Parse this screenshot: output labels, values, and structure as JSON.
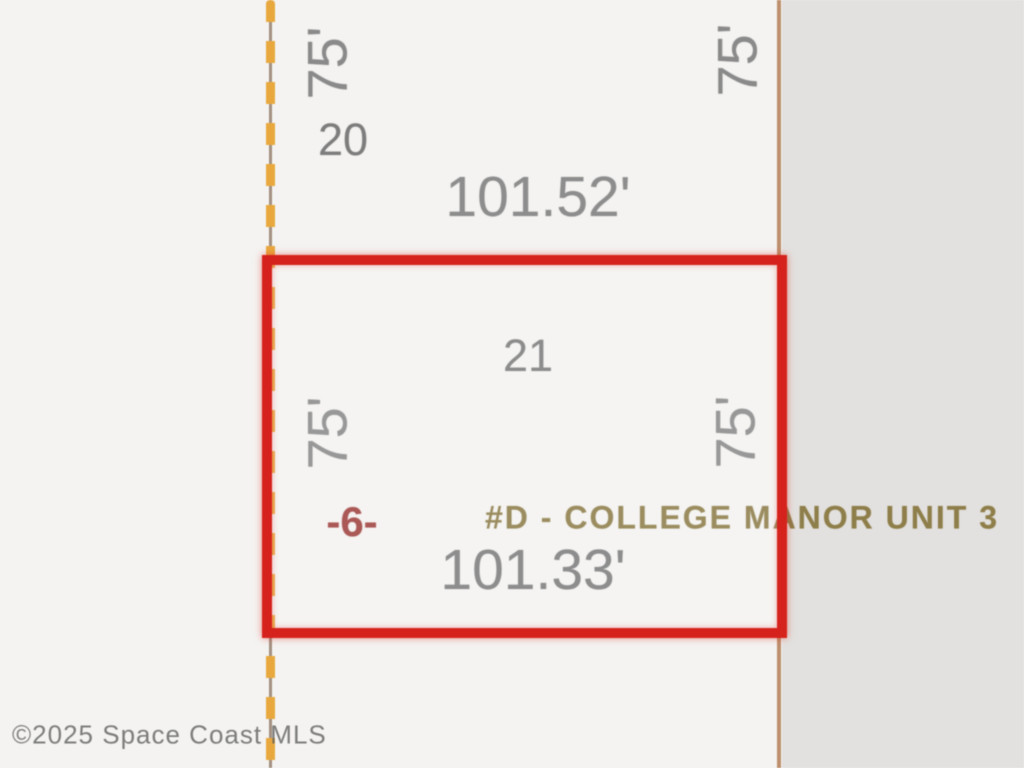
{
  "map": {
    "watermark": "©2025 Space Coast MLS",
    "subdivision_label": "#D - COLLEGE MANOR UNIT 3",
    "lots": [
      {
        "number": "20",
        "side_left": "75'",
        "side_right": "75'",
        "bottom_dimension": "101.52'",
        "highlighted": false
      },
      {
        "number": "21",
        "side_left": "75'",
        "side_right": "75'",
        "bottom_dimension": "101.33'",
        "parcel_marker": "-6-",
        "highlighted": true
      }
    ],
    "colors": {
      "background_left": "#f4f3f1",
      "background_right": "#e3e1df",
      "selected_lot_outline": "#d6221c",
      "west_boundary_dash": "#e9a83e",
      "east_boundary_line": "#bd8f6d",
      "dimension_text": "#8d8d8d",
      "lot_number_text": "#7d7d7d",
      "subdivision_text": "#8e7e4a",
      "parcel_marker_text": "#a04340",
      "watermark_text": "#5f5f5f"
    }
  }
}
